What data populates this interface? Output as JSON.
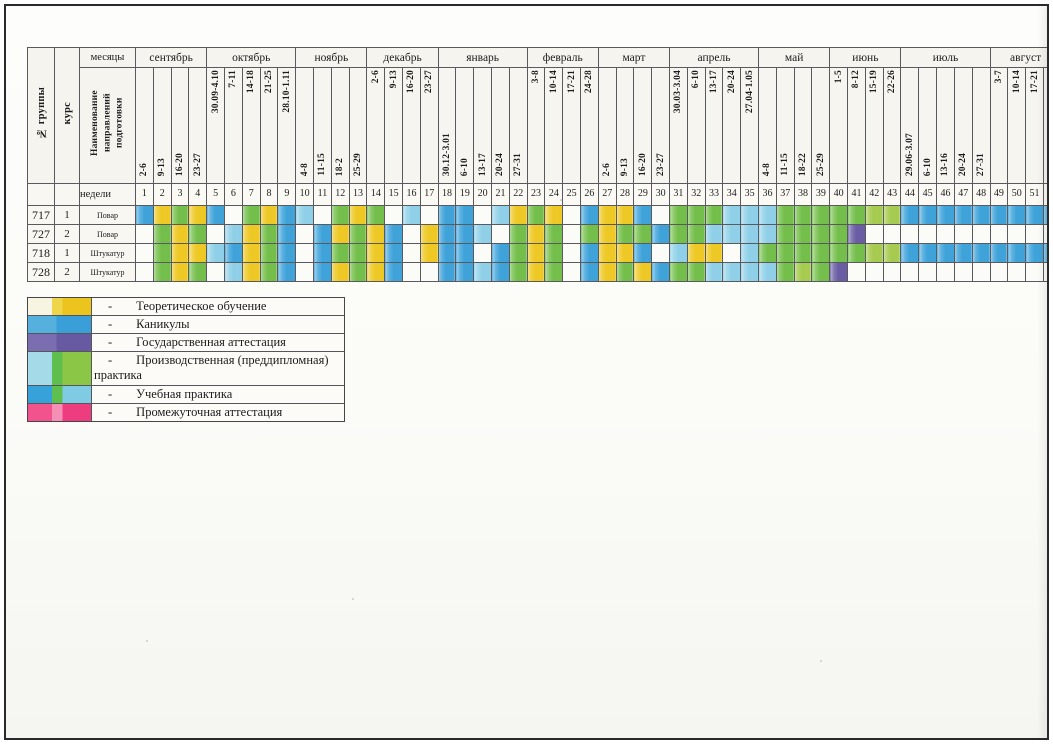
{
  "table": {
    "group_label": "№ группы",
    "course_label": "курс",
    "months_label": "месяцы",
    "program_label": "Наименование направлений подготовки",
    "weeks_label": "недели",
    "months": [
      {
        "name": "сентябрь",
        "weeks": [
          "2-6",
          "9-13",
          "16-20",
          "23-27"
        ]
      },
      {
        "name": "октябрь",
        "weeks": [
          "30.09-4.10",
          "7-11",
          "14-18",
          "21-25",
          "28.10-1.11"
        ]
      },
      {
        "name": "ноябрь",
        "weeks": [
          "4-8",
          "11-15",
          "18-2",
          "25-29"
        ]
      },
      {
        "name": "декабрь",
        "weeks": [
          "2-6",
          "9-13",
          "16-20",
          "23-27"
        ]
      },
      {
        "name": "январь",
        "weeks": [
          "30.12-3.01",
          "6-10",
          "13-17",
          "20-24",
          "27-31"
        ]
      },
      {
        "name": "февраль",
        "weeks": [
          "3-8",
          "10-14",
          "17-21",
          "24-28"
        ]
      },
      {
        "name": "март",
        "weeks": [
          "2-6",
          "9-13",
          "16-20",
          "23-27"
        ]
      },
      {
        "name": "апрель",
        "weeks": [
          "30.03-3.04",
          "6-10",
          "13-17",
          "20-24",
          "27.04-1.05"
        ]
      },
      {
        "name": "май",
        "weeks": [
          "4-8",
          "11-15",
          "18-22",
          "25-29"
        ]
      },
      {
        "name": "июнь",
        "weeks": [
          "1-5",
          "8-12",
          "15-19",
          "22-26"
        ]
      },
      {
        "name": "июль",
        "weeks": [
          "29.06-3.07",
          "6-10",
          "13-16",
          "20-24",
          "27-31"
        ]
      },
      {
        "name": "август",
        "weeks": [
          "3-7",
          "10-14",
          "17-21",
          "24-28"
        ]
      }
    ],
    "rows": [
      {
        "group": "717",
        "course": "1",
        "name": "Повар",
        "cells": "BYGYBWGYBCWGYGWCWBBWCYGYWBYYBWGGGCCCGGGGGLLBBBBBBBBB"
      },
      {
        "group": "727",
        "course": "2",
        "name": "Повар",
        "cells": "WGYGWCYGBWBYGYBWYBBCWGYGWGYGGBGGCCCCGGGGPWWWWWWWWWWW"
      },
      {
        "group": "718",
        "course": "1",
        "name": "Штукатур",
        "cells": "WGYYCBYGBWBGGYBWYBBWBGYGWBYYBWCYYWCGGGGGGLLBBBBBBBBB"
      },
      {
        "group": "728",
        "course": "2",
        "name": "Штукатур",
        "cells": "WGYGWCYGBWBYGYBWWBBCBGYGWBYGYBGGCCCCGLGPWWWWWWWWWWWW"
      }
    ],
    "palette": {
      "B": "#3fa3da",
      "Y": "#eec824",
      "G": "#74bf4b",
      "C": "#8fd0e8",
      "P": "#6a5da4",
      "L": "#a6cb50",
      "W": ""
    }
  },
  "legend": {
    "dash": "-",
    "items": [
      {
        "key": "theory",
        "label": "Теоретическое обучение",
        "colors": [
          "#f8f4e2",
          "#efd54a",
          "#ecc41e"
        ]
      },
      {
        "key": "vacation",
        "label": "Каникулы",
        "colors": [
          "#56b0de",
          "#3a9fd8"
        ]
      },
      {
        "key": "state-attestation",
        "label": "Государственная аттестация",
        "colors": [
          "#7a6eb0",
          "#675aa2"
        ]
      },
      {
        "key": "pre-diploma-practice",
        "label": "Производственная (преддипломная) практика",
        "colors": [
          "#a5dbe9",
          "#5fbf4e",
          "#8cc646"
        ]
      },
      {
        "key": "training-practice",
        "label": "Учебная практика",
        "colors": [
          "#37a2d9",
          "#5fbf4e",
          "#7fcbe4"
        ]
      },
      {
        "key": "interim-attestation",
        "label": "Промежуточная аттестация",
        "colors": [
          "#f2538d",
          "#f590b5",
          "#ee3d7e"
        ]
      }
    ]
  }
}
